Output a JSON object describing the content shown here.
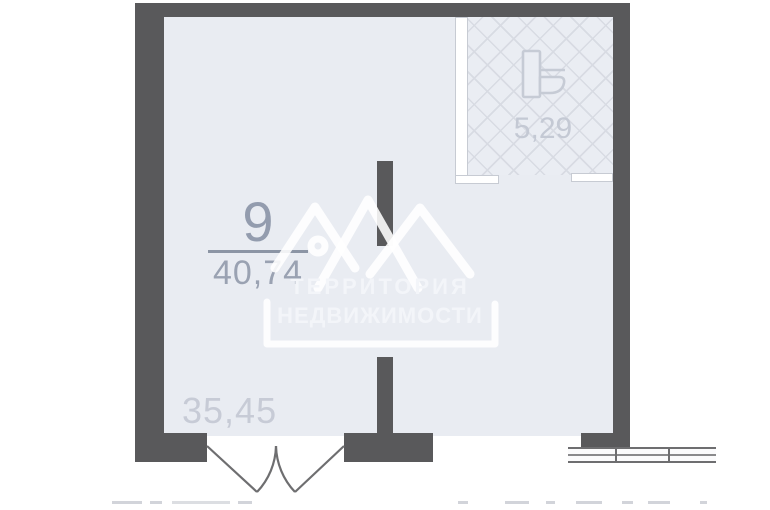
{
  "floor_plan": {
    "unit": {
      "number": "9",
      "total_area": "40,74"
    },
    "main_room": {
      "area": "35,45"
    },
    "bathroom": {
      "area": "5,29",
      "fixture_icon": "toilet-icon"
    },
    "features": [
      "double-entrance-door-swing",
      "three-pane-window",
      "tiled-bathroom-hatch"
    ]
  },
  "watermark": {
    "logo": "mountains-house-logo",
    "line1": "ТЕРРИТОРИЯ",
    "line2": "НЕДВИЖИМОСТИ"
  },
  "colors": {
    "wall": "#59595b",
    "floor": "#e9ecf2",
    "hatch_line": "#d8dbe3",
    "thin_wall": "#ffffff",
    "outline": "#6e6e70",
    "unit_label": "#99a1b1",
    "light_label": "#c7cbd5",
    "watermark": "#f3f5f9"
  }
}
